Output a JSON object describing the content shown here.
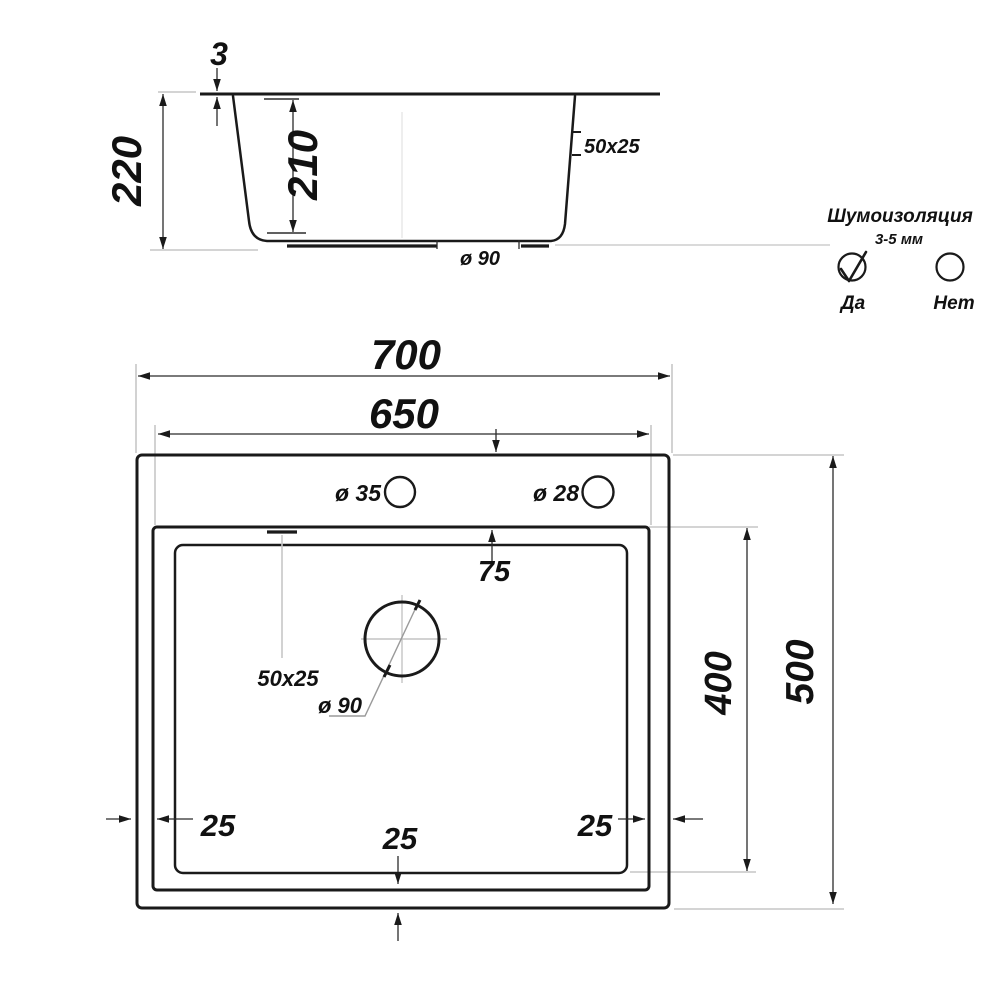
{
  "side_view": {
    "rim_thickness": "3",
    "total_height": "220",
    "bowl_depth": "210",
    "overflow": "50x25",
    "drain": "ø 90"
  },
  "insulation": {
    "title": "Шумоизоляция",
    "range": "3-5 мм",
    "yes_label": "Да",
    "no_label": "Нет",
    "yes_checked": true,
    "no_checked": false
  },
  "top_view": {
    "outer_width": "700",
    "bowl_width": "650",
    "faucet_hole": "ø 35",
    "dispenser_hole": "ø 28",
    "deck_offset": "75",
    "overflow": "50x25",
    "drain": "ø 90",
    "bowl_length": "400",
    "outer_depth": "500",
    "gap_left": "25",
    "gap_right": "25",
    "gap_bottom": "25"
  },
  "colors": {
    "ink": "#1a1a1a",
    "dimension_line": "#2b2b2b",
    "extension_line": "#c6c6c6",
    "background": "#ffffff"
  }
}
